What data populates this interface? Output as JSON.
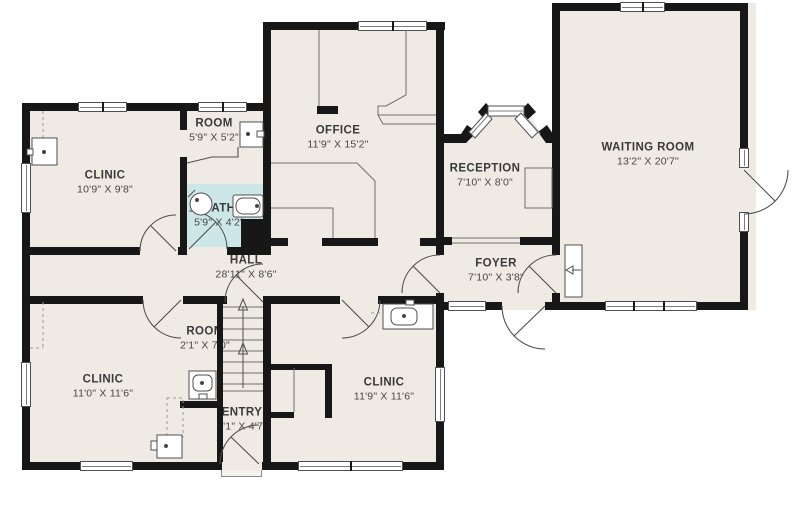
{
  "title": "Floor plan",
  "colors": {
    "wall": "#171717",
    "floor": "#efeae3",
    "bath_floor": "#cde7e9",
    "line": "#4f4f4f"
  },
  "rooms": [
    {
      "id": "clinic-top-left",
      "name": "CLINIC",
      "dims": "10'9\" X 9'8\""
    },
    {
      "id": "room-top",
      "name": "ROOM",
      "dims": "5'9\" X 5'2\""
    },
    {
      "id": "office",
      "name": "OFFICE",
      "dims": "11'9\" X 15'2\""
    },
    {
      "id": "reception",
      "name": "RECEPTION",
      "dims": "7'10\" X 8'0\""
    },
    {
      "id": "waiting-room",
      "name": "WAITING ROOM",
      "dims": "13'2\" X 20'7\""
    },
    {
      "id": "bath",
      "name": "BATH",
      "dims": "5'9\" X 4'2\""
    },
    {
      "id": "hall",
      "name": "HALL",
      "dims": "28'11\" X 8'6\""
    },
    {
      "id": "foyer",
      "name": "FOYER",
      "dims": "7'10\" X 3'8\""
    },
    {
      "id": "clinic-bottom-left",
      "name": "CLINIC",
      "dims": "11'0\" X 11'6\""
    },
    {
      "id": "room-small",
      "name": "ROOM",
      "dims": "2'1\" X 7'0\""
    },
    {
      "id": "entry",
      "name": "ENTRY",
      "dims": "3'1\" X 4'7\""
    },
    {
      "id": "clinic-bottom-middle",
      "name": "CLINIC",
      "dims": "11'9\" X 11'6\""
    }
  ]
}
